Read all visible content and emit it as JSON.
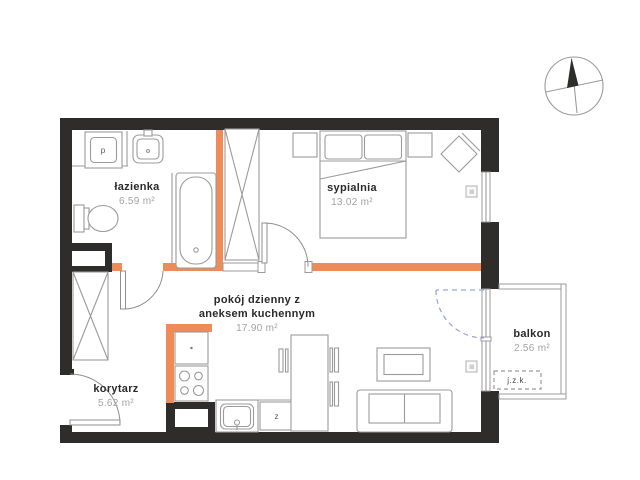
{
  "colors": {
    "wall": "#2e2d2b",
    "accent": "#f08a56",
    "balcony_dash": "#9aa3d8"
  },
  "rooms": {
    "bathroom": {
      "name": "łazienka",
      "area": "6.59 m²"
    },
    "bedroom": {
      "name": "sypialnia",
      "area": "13.02 m²"
    },
    "living": {
      "name_line1": "pokój dzienny z",
      "name_line2": "aneksem kuchennym",
      "area": "17.90 m²"
    },
    "corridor": {
      "name": "korytarz",
      "area": "5.62 m²"
    },
    "balcony": {
      "name": "balkon",
      "area": "2.56 m²"
    }
  },
  "tags": {
    "washing_machine": "p",
    "dishwasher": "z",
    "ac_unit": "j.z.k."
  }
}
